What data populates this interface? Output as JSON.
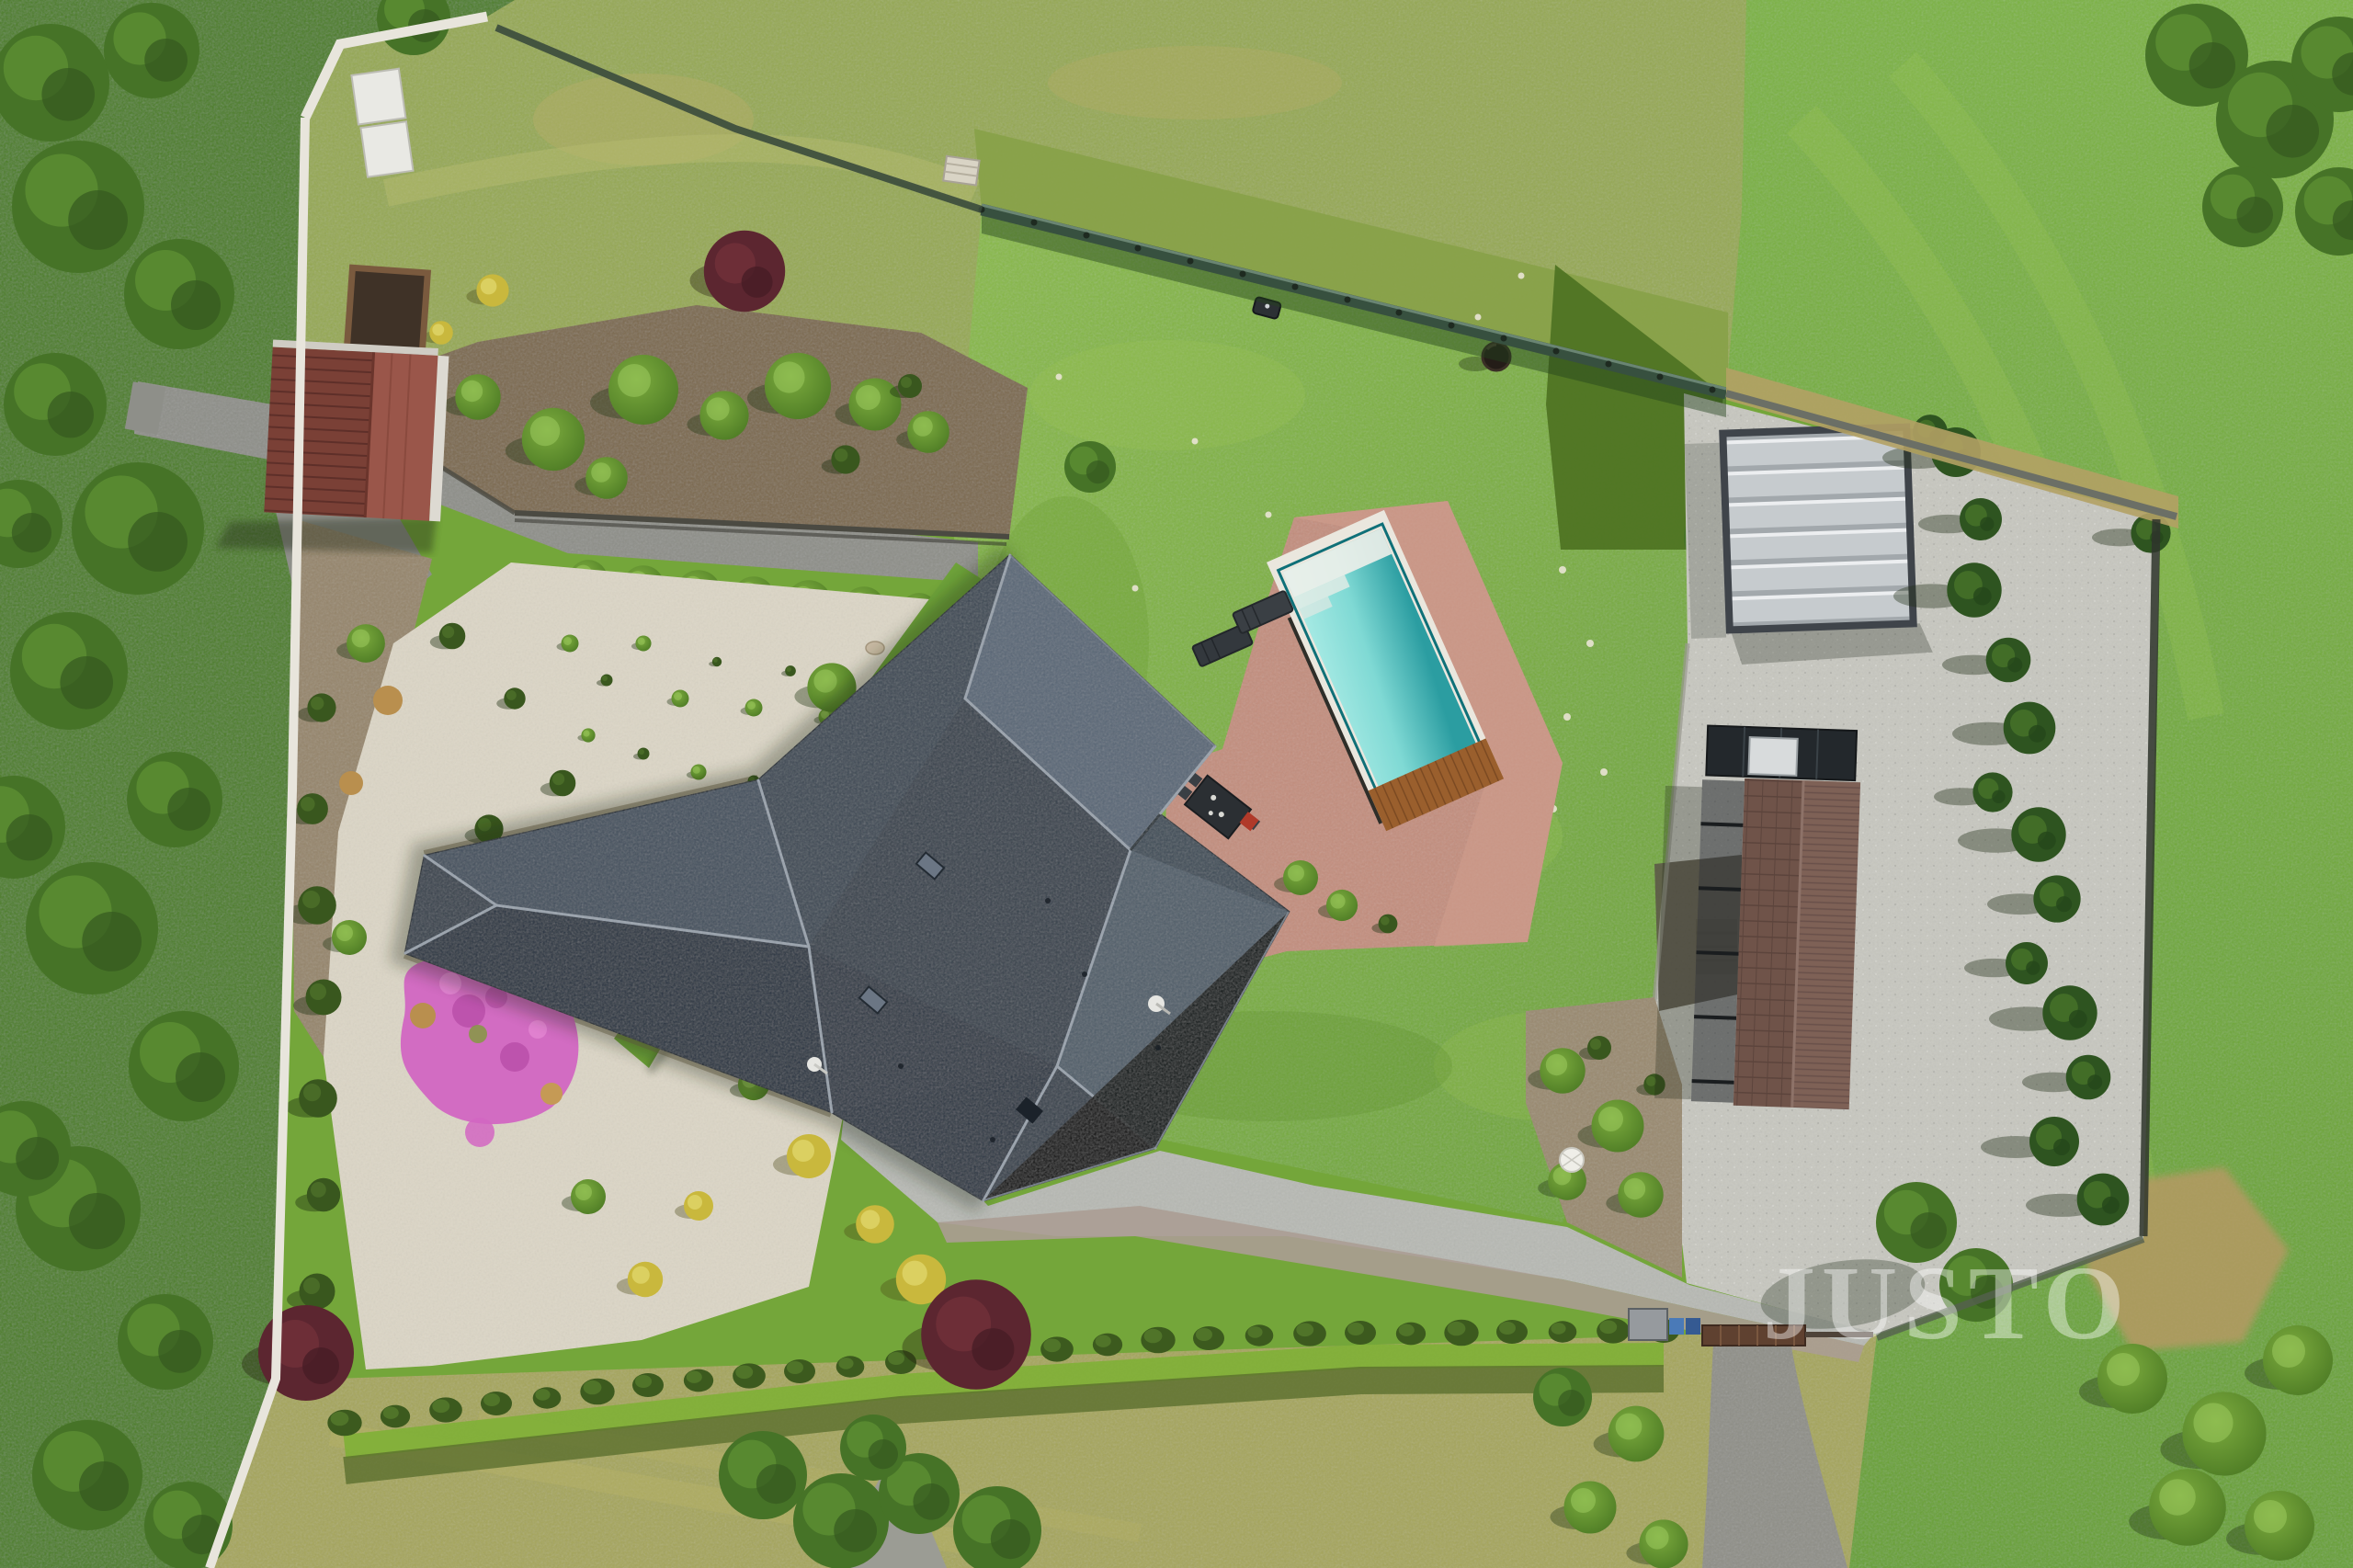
{
  "scene": {
    "type": "aerial-drone-photograph",
    "description": "Top-down aerial view of a residential property: a family house with a dark graphite hipped roof, backyard terrace with pool, large lawn, white-gravel rock garden, garden shed, long brown-roofed outbuilding with paved courtyard and carport, surrounded by meadows, hedges and a tree strip.",
    "watermark": {
      "text": "JUSTO",
      "color": "#ffffff",
      "opacity": 0.42
    },
    "palette": {
      "lawn_green": "#7fb13b",
      "meadow_top": "#96a952",
      "field_right": "#74a93a",
      "field_bottom": "#a6a65c",
      "forest": "#4e7f28",
      "roof_dark": "#2e3844",
      "roof_light": "#5a6877",
      "terrace_paving": "#c38e7e",
      "pool_water_light": "#a9ebe5",
      "pool_water_deep": "#2b9da1",
      "pool_coping": "#eae7de",
      "wood_deck": "#99602e",
      "white_gravel": "#dcd6c6",
      "gray_gravel": "#8e8f89",
      "courtyard_pavers": "#c7c7c0",
      "asphalt": "#b7b9b4",
      "shed_roof": "#7a4036",
      "garage_roof": "#6f5349",
      "carport_canopy": "#c6cbce",
      "hedge_conifer": "#3c5a1e",
      "pink_flowers": "#d266c2",
      "purple_tree": "#5c2630",
      "white_wall": "#e8e5dc"
    },
    "elements": [
      {
        "name": "house",
        "label": "Family house with dark hipped roof"
      },
      {
        "name": "swimming-pool",
        "label": "Rectangular swimming pool"
      },
      {
        "name": "pool-deck",
        "label": "Wooden pool deck"
      },
      {
        "name": "terrace",
        "label": "Terracotta paved terrace"
      },
      {
        "name": "outdoor-dining-set",
        "label": "Outdoor dining set"
      },
      {
        "name": "sun-loungers",
        "label": "Two sun loungers"
      },
      {
        "name": "lawn",
        "label": "Main lawn"
      },
      {
        "name": "rock-garden",
        "label": "White gravel rock garden"
      },
      {
        "name": "pink-flower-patch",
        "label": "Pink flowering ground cover"
      },
      {
        "name": "garden-shed",
        "label": "Garden shed with red-brown roof"
      },
      {
        "name": "garage",
        "label": "Long outbuilding with brown roof"
      },
      {
        "name": "carport",
        "label": "Carport with silver canopy"
      },
      {
        "name": "paved-courtyard",
        "label": "Paved courtyard"
      },
      {
        "name": "driveway",
        "label": "Asphalt driveway"
      },
      {
        "name": "entrance-gate",
        "label": "Entrance gate with waste bins"
      },
      {
        "name": "dirt-road",
        "label": "Gravel access road"
      },
      {
        "name": "boundary-fence",
        "label": "Dark boundary fence"
      },
      {
        "name": "boundary-wall",
        "label": "White boundary wall"
      },
      {
        "name": "hedge-row",
        "label": "Young conifer hedge row"
      },
      {
        "name": "spruce-row",
        "label": "Row of spruces along courtyard"
      },
      {
        "name": "purple-trees",
        "label": "Purple-leaved ornamental trees"
      },
      {
        "name": "forest-strip",
        "label": "Tree strip along west boundary"
      },
      {
        "name": "meadow",
        "label": "Surrounding meadows"
      },
      {
        "name": "robotic-mower",
        "label": "Robotic lawn mower"
      },
      {
        "name": "fire-bowl",
        "label": "Dark round fire bowl on lawn"
      },
      {
        "name": "parasol",
        "label": "White garden parasol"
      },
      {
        "name": "pallet",
        "label": "Wooden pallet in meadow"
      },
      {
        "name": "raised-bed",
        "label": "Raised planting bed"
      },
      {
        "name": "cold-frames",
        "label": "White cold frames"
      }
    ]
  }
}
